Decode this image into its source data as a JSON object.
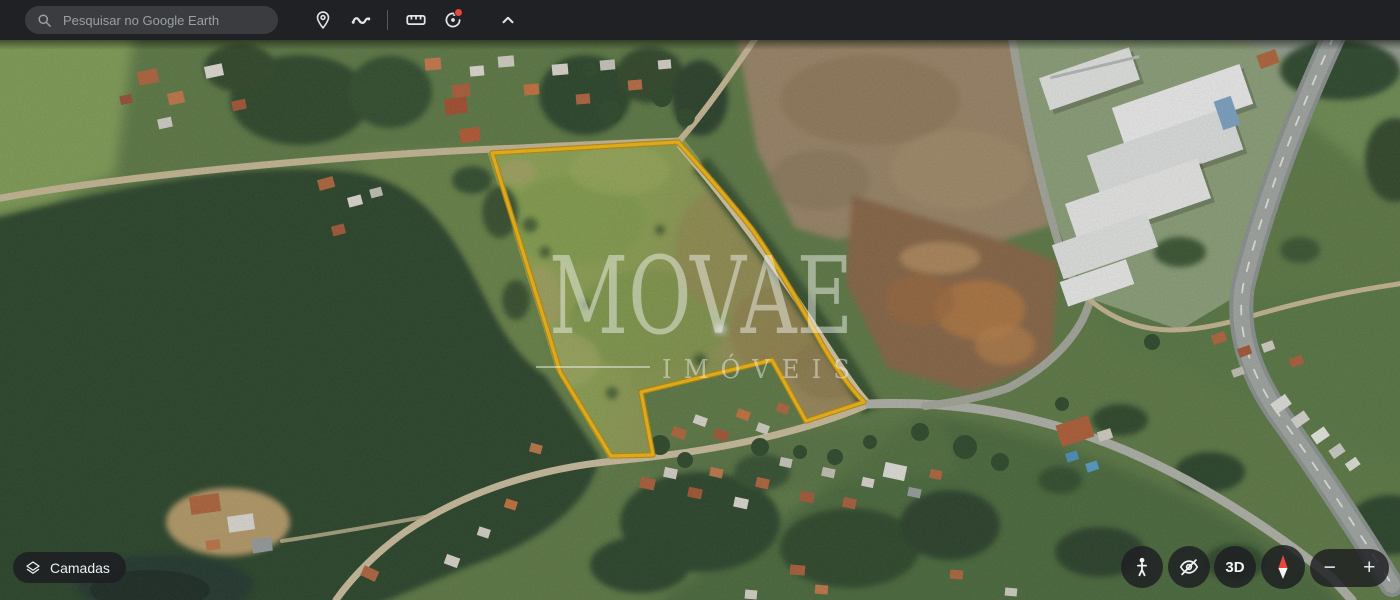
{
  "toolbar": {
    "search": {
      "placeholder": "Pesquisar no Google Earth",
      "icon": "search-icon"
    },
    "tools": [
      {
        "id": "add-placemark",
        "icon": "placemark-pin-icon"
      },
      {
        "id": "draw-path",
        "icon": "path-squiggle-icon"
      },
      {
        "id": "measure",
        "icon": "ruler-icon"
      },
      {
        "id": "historical-imagery",
        "icon": "history-clock-icon",
        "notification_dot": true
      },
      {
        "id": "collapse-toolbar",
        "icon": "chevron-up-icon"
      }
    ]
  },
  "watermark": {
    "brand": "MOVAE",
    "subtitle": "IMÓVEIS"
  },
  "layers_button": {
    "label": "Camadas",
    "icon": "layers-icon"
  },
  "map_controls": {
    "pegman": {
      "icon": "pegman-icon"
    },
    "hide_ui": {
      "icon": "eye-slash-icon"
    },
    "mode_3d": {
      "label": "3D"
    },
    "compass": {
      "icon": "compass-icon"
    },
    "zoom_out_label": "−",
    "zoom_in_label": "+"
  },
  "colors": {
    "toolbar_bg": "#202124",
    "control_bg": "#1F2023",
    "property_outline": "#F2B211",
    "notification_dot": "#E8453C",
    "compass_north": "#E8453C",
    "watermark": "rgba(242,244,240,0.48)",
    "pool_water": "#4F93C0"
  }
}
